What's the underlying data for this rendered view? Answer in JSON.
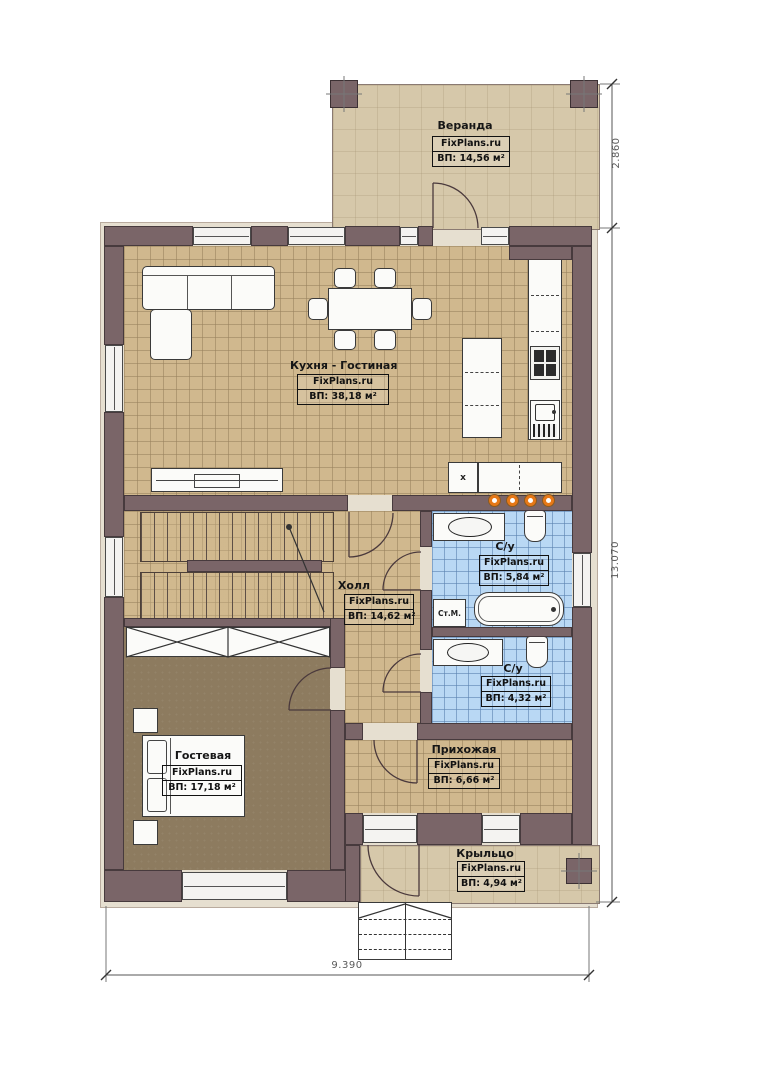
{
  "brand": "FixPlans.ru",
  "rooms": {
    "veranda": {
      "name": "Веранда",
      "area": "ВП: 14,56 м²"
    },
    "kitchen_living": {
      "name": "Кухня - Гостиная",
      "area": "ВП: 38,18 м²"
    },
    "bathroom_1": {
      "name": "С/у",
      "area": "ВП: 5,84 м²"
    },
    "hall": {
      "name": "Холл",
      "area": "ВП: 14,62 м²"
    },
    "bathroom_2": {
      "name": "С/у",
      "area": "ВП: 4,32 м²"
    },
    "guest_room": {
      "name": "Гостевая",
      "area": "ВП: 17,18 м²"
    },
    "entry_hall": {
      "name": "Прихожая",
      "area": "ВП: 6,66 м²"
    },
    "porch": {
      "name": "Крыльцо",
      "area": "ВП: 4,94 м²"
    }
  },
  "dimensions": {
    "veranda_depth": "2.860",
    "house_height": "13.070",
    "house_width": "9.390"
  },
  "fixtures": {
    "washing_machine": "Ст.М.",
    "appliance_mark": "x"
  },
  "colors": {
    "wall": "#7a6568",
    "floor_tile": "#d0b88e",
    "floor_guest": "#8d7b5f",
    "floor_bath": "#b9d8f4",
    "floor_deck": "#d6c8aa",
    "accent_dot": "#e67817"
  }
}
